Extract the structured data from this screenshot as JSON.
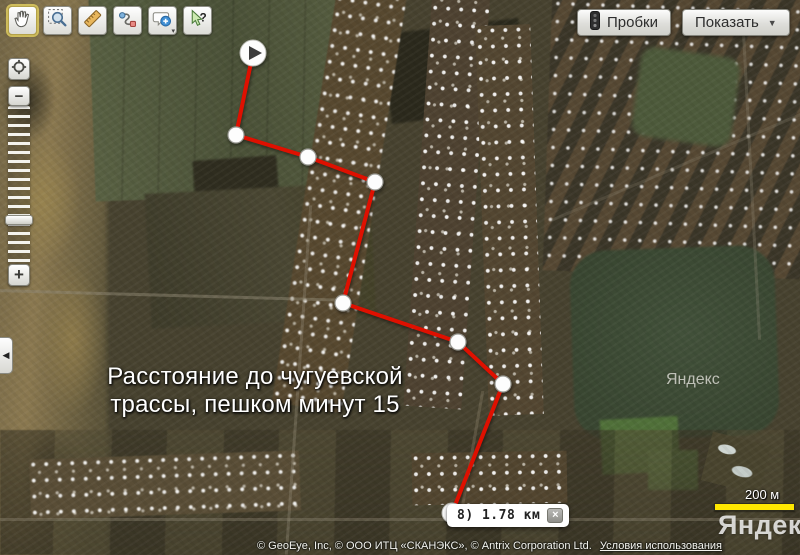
{
  "toolbar": {
    "selected_tool": "pan",
    "buttons": [
      {
        "id": "pan",
        "icon": "hand-icon",
        "selected": true
      },
      {
        "id": "select-zoom",
        "icon": "magnifier-icon",
        "selected": false
      },
      {
        "id": "ruler",
        "icon": "ruler-icon",
        "selected": false
      },
      {
        "id": "route",
        "icon": "route-icon",
        "selected": false
      },
      {
        "id": "add-comment",
        "icon": "balloon-plus-icon",
        "selected": false
      },
      {
        "id": "help",
        "icon": "help-cursor-icon",
        "selected": false
      }
    ]
  },
  "top_right": {
    "traffic_button": "Пробки",
    "traffic_icon": "traffic-light-icon",
    "show_button": "Показать",
    "show_arrow": "▼"
  },
  "zoom_control": {
    "locate_icon": "locate-icon",
    "zoom_out": "−",
    "zoom_in": "+"
  },
  "panel_toggle": {
    "arrow": "◀"
  },
  "map_overlay_text": {
    "line1": "Расстояние до чугуевской",
    "line2": "трассы, пешком минут 15"
  },
  "route": {
    "color": "#df1000",
    "points": [
      [
        253,
        53
      ],
      [
        236,
        135
      ],
      [
        308,
        157
      ],
      [
        375,
        182
      ],
      [
        343,
        303
      ],
      [
        458,
        342
      ],
      [
        503,
        384
      ],
      [
        452,
        513
      ]
    ],
    "start_icon": "play-icon",
    "end_icon": "square-icon",
    "distance_label": "8) 1.78 км",
    "close_icon": "×"
  },
  "scale_bar": {
    "label": "200 м",
    "color": "#ffe800"
  },
  "watermarks": {
    "field_label": "Яндекс",
    "logo": "Яндекс"
  },
  "attribution": {
    "copyright": "© GeoEye, Inc, © ООО ИТЦ «СКАНЭКС», © Antrix Corporation Ltd.",
    "terms_link": "Условия использования"
  }
}
